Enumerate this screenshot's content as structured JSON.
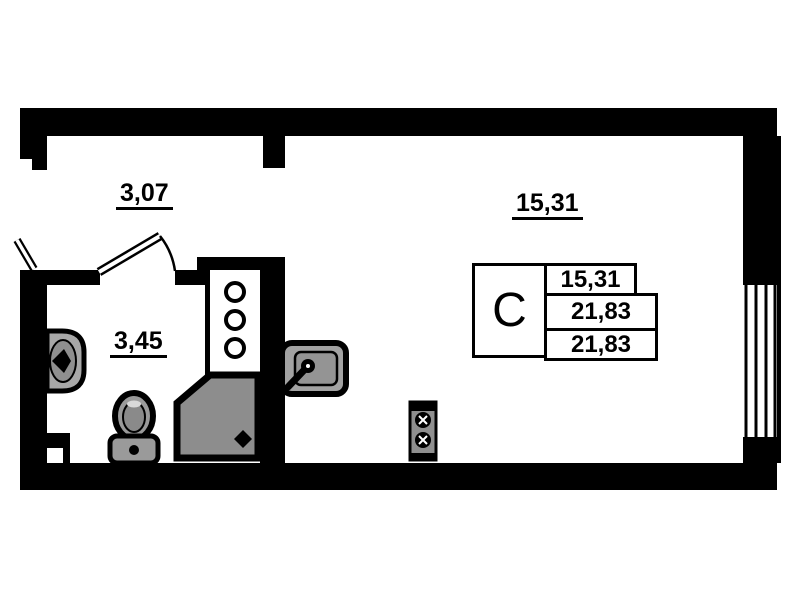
{
  "plan": {
    "type": "studio-apartment-floor-plan",
    "rooms": {
      "hallway": {
        "area": "3,07"
      },
      "bathroom": {
        "area": "3,45"
      },
      "living": {
        "area": "15,31"
      }
    },
    "stamp": {
      "type_label": "С",
      "rows": [
        "15,31",
        "21,83",
        "21,83"
      ]
    },
    "colors": {
      "wall": "#000000",
      "background": "#ffffff",
      "fixture_fill": "#9a9a9a",
      "fixture_fill_dark": "#8d8d8d"
    },
    "icons": [
      "entrance-door-icon",
      "bathroom-door-icon",
      "window-icon",
      "ventilation-shaft-icon",
      "shower-icon",
      "washbasin-icon",
      "toilet-icon",
      "kitchen-sink-icon",
      "stove-icon"
    ]
  }
}
